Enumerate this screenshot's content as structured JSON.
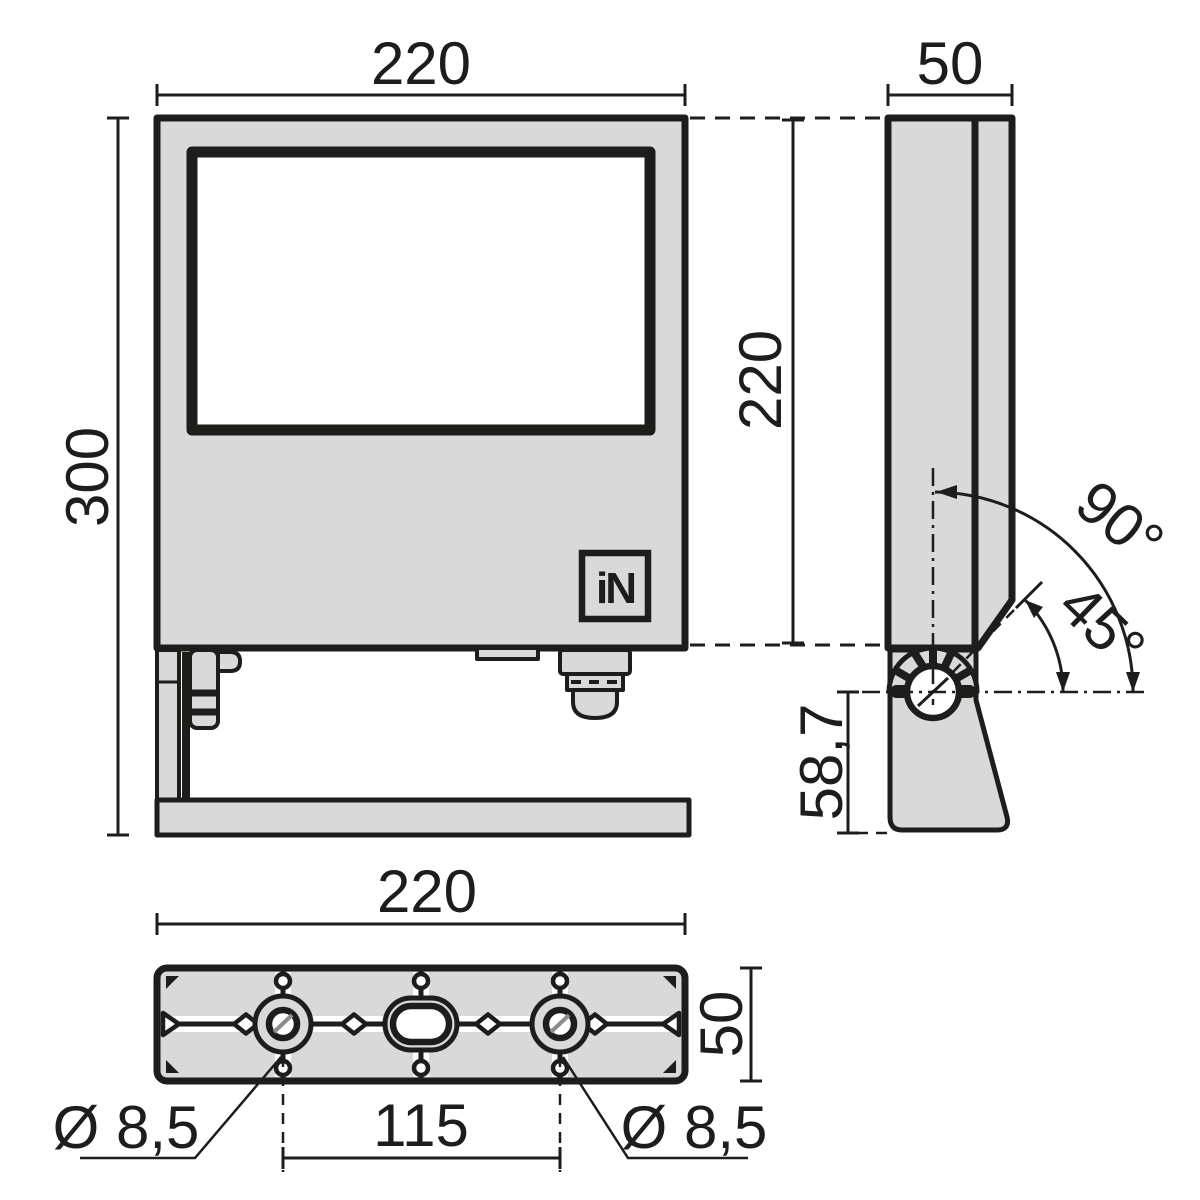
{
  "drawing": {
    "type": "luminaire-dimension-drawing",
    "front_view": {
      "width_label": "220",
      "height_label": "300",
      "logo_text": "iN"
    },
    "side_view": {
      "depth_label": "50",
      "housing_height_label": "220",
      "tilt_full_label": "90°",
      "tilt_half_label": "45°",
      "pivot_offset_label": "58,7"
    },
    "bottom_view": {
      "width_label": "220",
      "depth_label": "50",
      "hole_spacing_label": "115",
      "hole_left_label": "Ø 8,5",
      "hole_right_label": "Ø 8,5"
    },
    "colors": {
      "line": "#1d1d1b",
      "part_fill": "#d9d9d9",
      "background": "#ffffff"
    }
  }
}
